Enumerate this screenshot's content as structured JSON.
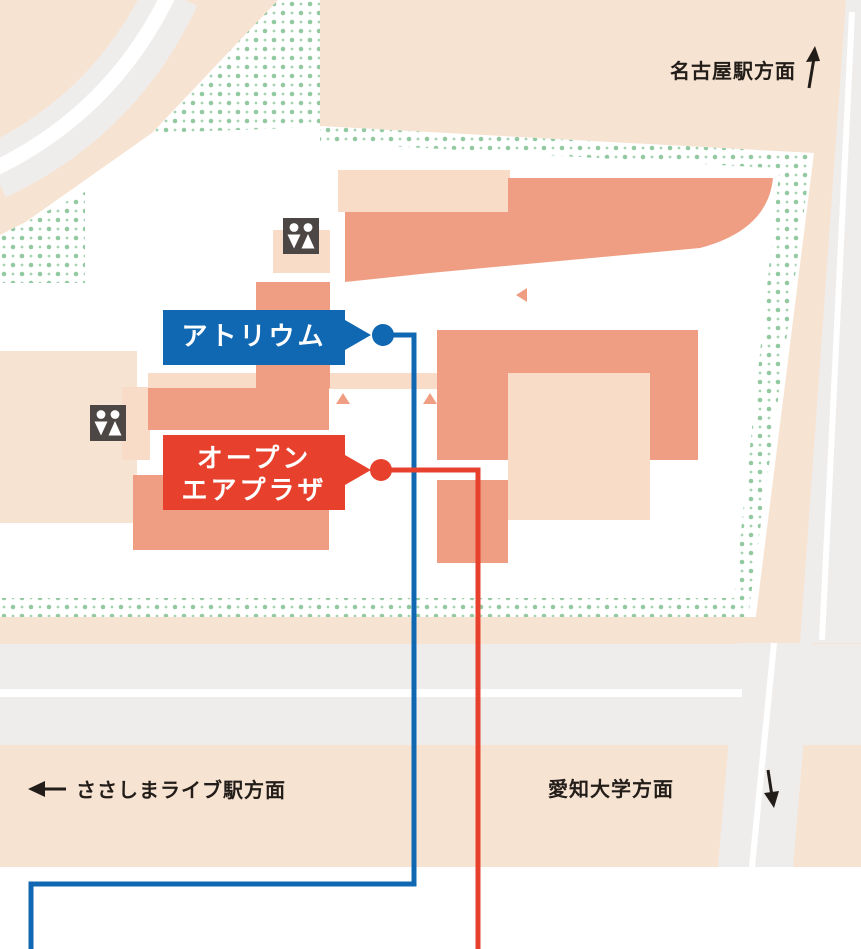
{
  "title": "venue access map",
  "palette": {
    "beige": "#f7e3d2",
    "peach": "#f8dcc8",
    "salmon": "#ef9e83",
    "road": "#efedec",
    "dot-green": "#92c9a1",
    "dot-green-light": "#a5d2b2",
    "ink": "#221d19",
    "icon-bg": "#4c4745"
  },
  "directions": {
    "nagoya": {
      "label": "名古屋駅方面",
      "arrow": "up"
    },
    "sasashima": {
      "label": "ささしまライブ駅方面",
      "arrow": "left"
    },
    "aichi": {
      "label": "愛知大学方面",
      "arrow": "down"
    }
  },
  "callouts": {
    "atrium": {
      "label": "アトリウム",
      "color": "#1168b2"
    },
    "plaza": {
      "line1": "オープン",
      "line2": "エアプラザ",
      "color": "#e7402d"
    }
  },
  "icons": {
    "restroom": "restroom-icon"
  }
}
